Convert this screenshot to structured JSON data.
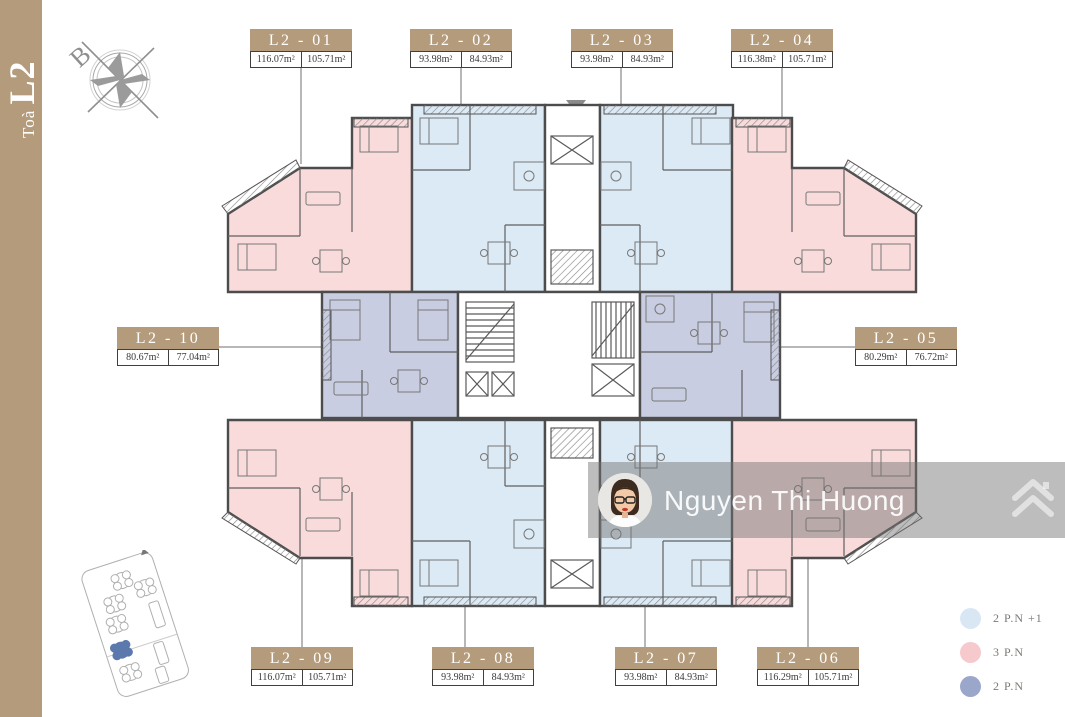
{
  "sidebar": {
    "tower_label_small": "Toà ",
    "tower_label_large": "L2"
  },
  "compass": {
    "north_label": "B"
  },
  "plan": {
    "units": [
      {
        "label": "L2 - 01",
        "area_total": "116.07m²",
        "area_usable": "105.71m²",
        "type": "3 P.N"
      },
      {
        "label": "L2 - 02",
        "area_total": "93.98m²",
        "area_usable": "84.93m²",
        "type": "2 P.N +1"
      },
      {
        "label": "L2 - 03",
        "area_total": "93.98m²",
        "area_usable": "84.93m²",
        "type": "2 P.N +1"
      },
      {
        "label": "L2 - 04",
        "area_total": "116.38m²",
        "area_usable": "105.71m²",
        "type": "3 P.N"
      },
      {
        "label": "L2 - 05",
        "area_total": "80.29m²",
        "area_usable": "76.72m²",
        "type": "2 P.N"
      },
      {
        "label": "L2 - 06",
        "area_total": "116.29m²",
        "area_usable": "105.71m²",
        "type": "3 P.N"
      },
      {
        "label": "L2 - 07",
        "area_total": "93.98m²",
        "area_usable": "84.93m²",
        "type": "2 P.N +1"
      },
      {
        "label": "L2 - 08",
        "area_total": "93.98m²",
        "area_usable": "84.93m²",
        "type": "2 P.N +1"
      },
      {
        "label": "L2 - 09",
        "area_total": "116.07m²",
        "area_usable": "105.71m²",
        "type": "3 P.N"
      },
      {
        "label": "L2 - 10",
        "area_total": "80.67m²",
        "area_usable": "77.04m²",
        "type": "2 P.N"
      }
    ]
  },
  "legend": {
    "items": [
      {
        "label": "2 P.N +1",
        "color": "#d9e7f4"
      },
      {
        "label": "3 P.N",
        "color": "#f6c9cd"
      },
      {
        "label": "2 P.N",
        "color": "#9aa6ca"
      }
    ]
  },
  "watermark": {
    "name": "Nguyen Thi Huong"
  },
  "colors": {
    "accent_tan": "#b49b7c",
    "unit_2pn_plus1": "#dceaf5",
    "unit_3pn": "#f8dbda",
    "unit_2pn": "#c8cde1",
    "wall": "#4c4c4c"
  }
}
